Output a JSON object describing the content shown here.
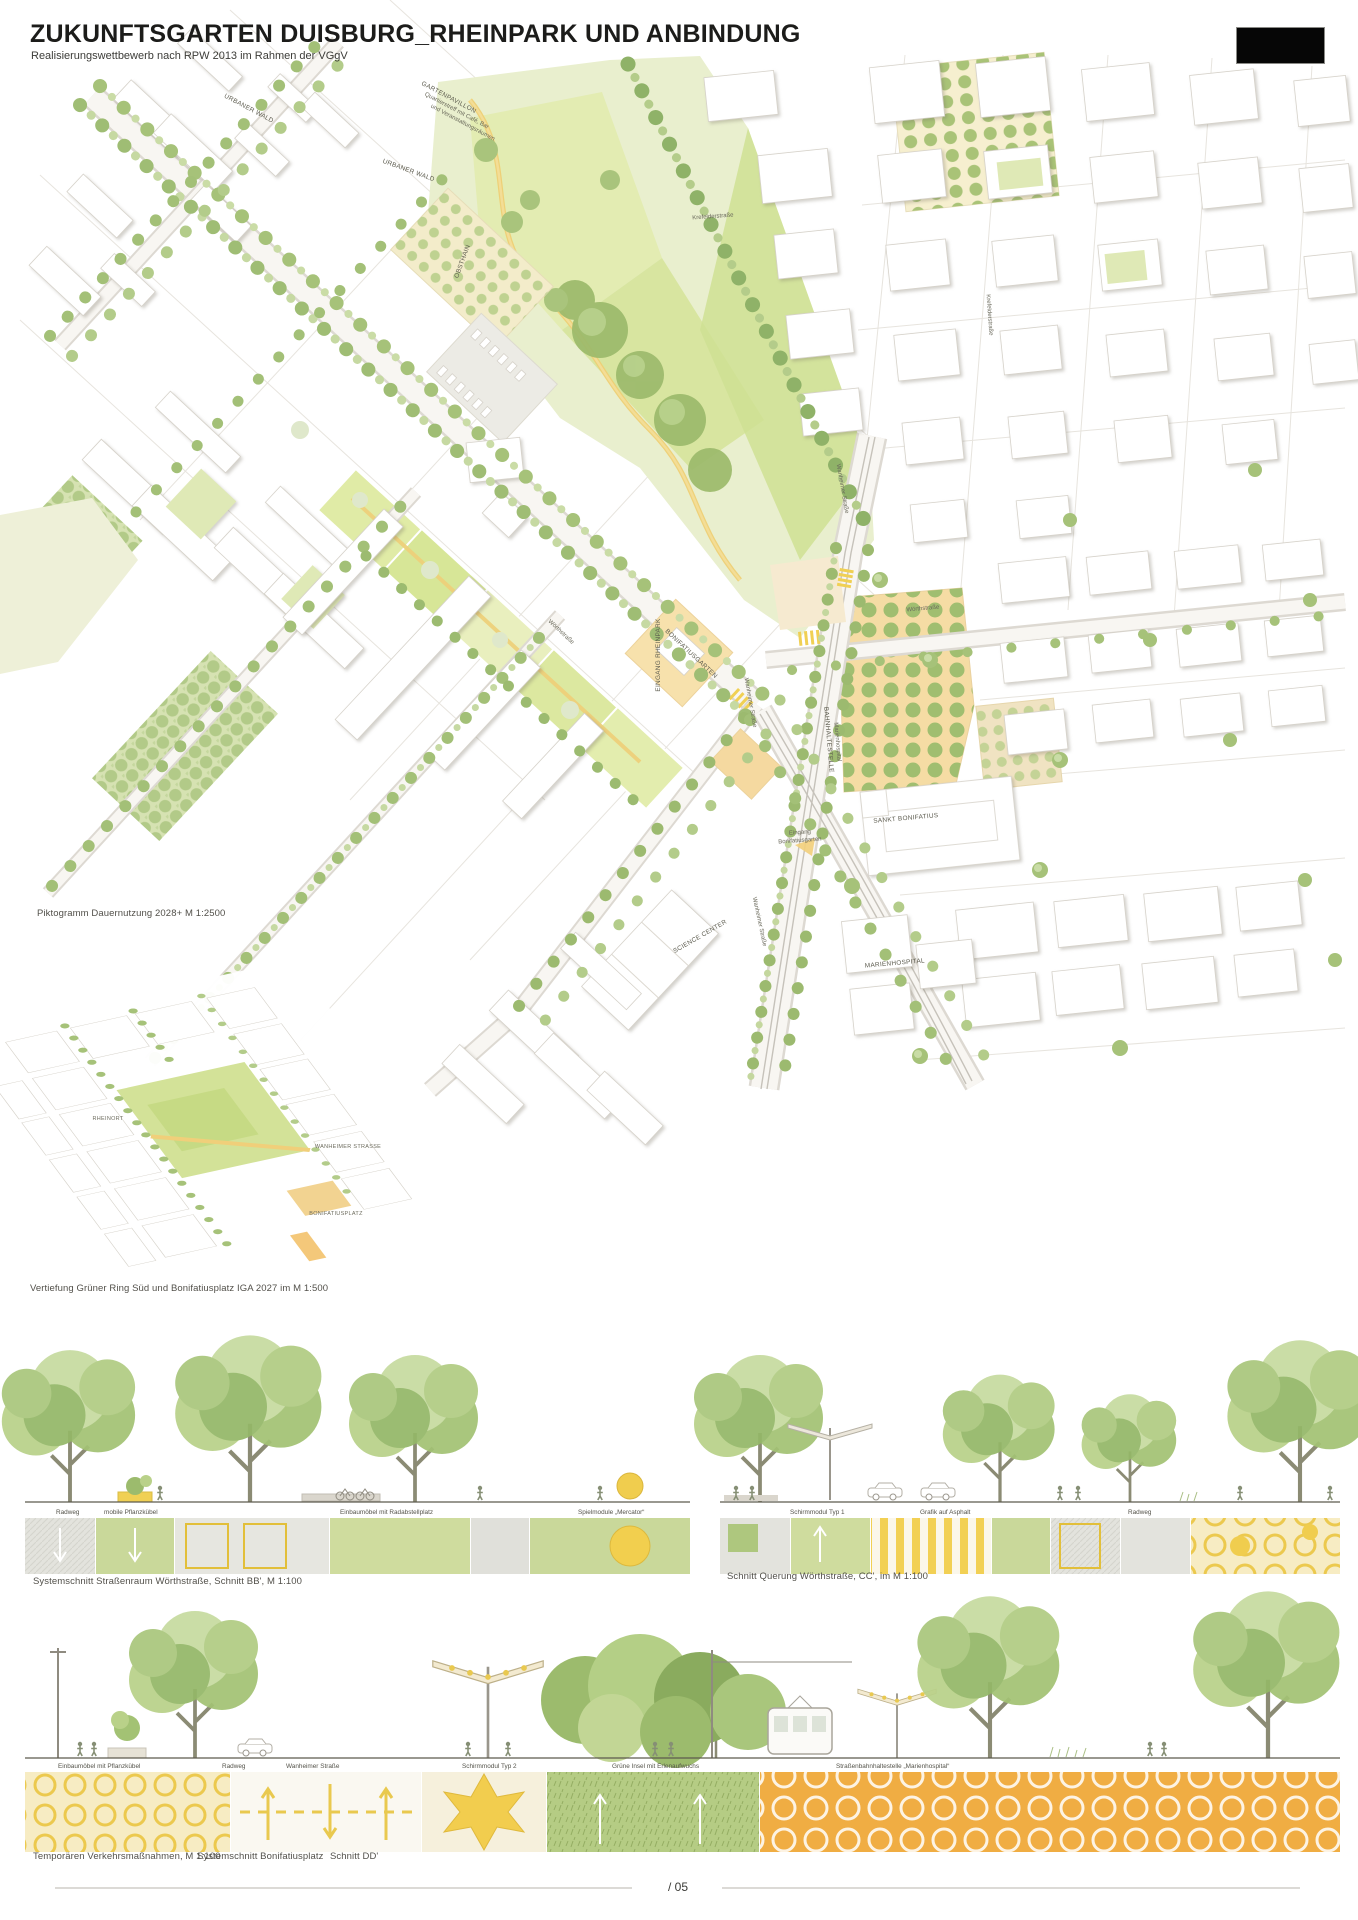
{
  "header": {
    "title": "ZUKUNFTSGARTEN DUISBURG_RHEINPARK UND ANBINDUNG",
    "subtitle": "Realisierungswettbewerb nach RPW 2013 im Rahmen der VGgV"
  },
  "plan_labels": [
    "URBANER WALD",
    "GARTENPAVILLON",
    "Quartierstreff mit Café, Bar",
    "und Veranstaltungsräumen",
    "URBANER WALD",
    "OBSTHAIN",
    "Krefelderstraße",
    "Krefelderstraße",
    "Wanheimer Straße",
    "Wörthstraße",
    "EINGANG RHEINPARK",
    "BONIFATIUSGARTEN",
    "Wanheimer Straße",
    "BAHNHALTESTELLE",
    "Marienhospital",
    "Eingang",
    "Bonifatiusgarten",
    "SANKT BONIFATIUS",
    "Wanheimer Straße",
    "SCIENCE CENTER",
    "MARIENHOSPITAL",
    "Wörthstraße"
  ],
  "pikto_labels": [
    "RHEINORT",
    "WANHEIMER STRASSE",
    "BONIFATIUSPLATZ"
  ],
  "captions": {
    "pikto": "Piktogramm Dauernutzung 2028+ M 1:2500",
    "vertiefung": "Vertiefung Grüner Ring Süd und Bonifatiusplatz IGA 2027 im M 1:500",
    "band1_left": "Systemschnitt Straßenraum Wörthstraße, Schnitt BB', M 1:100",
    "band1_right": "Schnitt Querung Wörthstraße, CC', im M 1:100",
    "band2_1": "Temporären Verkehrsmaßnahmen, M 1:100",
    "band2_2": "Systemschnitt Bonifatiusplatz",
    "band2_3": "Schnitt DD'"
  },
  "band1_labels": [
    "Radweg",
    "mobile Pflanzkübel",
    "Einbaumöbel mit Radabstellplatz",
    "Spielmodule „Mercator“",
    "Schirmmodul Typ 1",
    "Grafik auf Asphalt",
    "Radweg"
  ],
  "band2_labels": [
    "Einbaumöbel mit Pflanzkübel",
    "Radweg",
    "Wanheimer Straße",
    "Schirmmodul Typ 2",
    "Grüne Insel mit Erlenaufwuchs",
    "Straßenbahnhaltestelle „Marienhospital“"
  ],
  "footer": {
    "page": "/ 05"
  },
  "colors": {
    "tree_green": "#a6c279",
    "lawn_green": "#dce8a8",
    "path_yellow": "#eecf74",
    "plaza_orange": "#f0ad43",
    "subsoil_yellow": "#f2cd4e",
    "ink": "#2a2a28"
  }
}
